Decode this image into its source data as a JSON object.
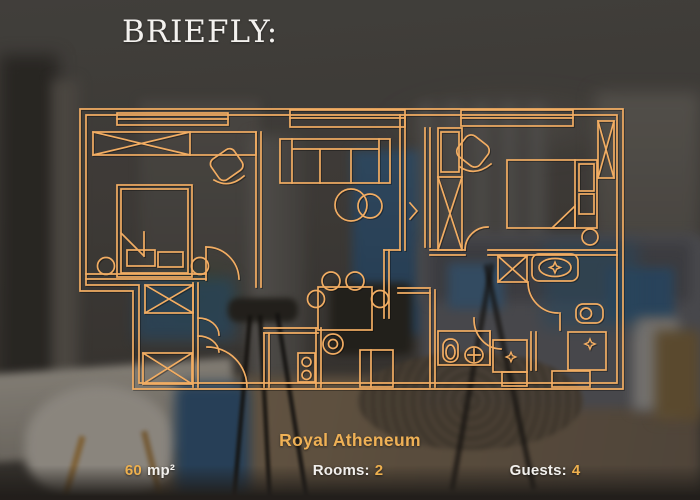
{
  "brand": {
    "title": "BRIEFLY:"
  },
  "listing": {
    "name": "Royal Atheneum",
    "area_value": "60",
    "area_unit": "mp²",
    "rooms_label": "Rooms:",
    "rooms_value": "2",
    "guests_label": "Guests:",
    "guests_value": "4"
  },
  "floor_plan": {
    "content": "apartment floor plan line drawing with two bedrooms, living room, kitchen, hallway and bathroom",
    "line_color": "#f2ad63"
  },
  "colors": {
    "accent_gold": "#efb156",
    "number_gold": "#eeb04e",
    "text_white": "#f2f0ed"
  }
}
